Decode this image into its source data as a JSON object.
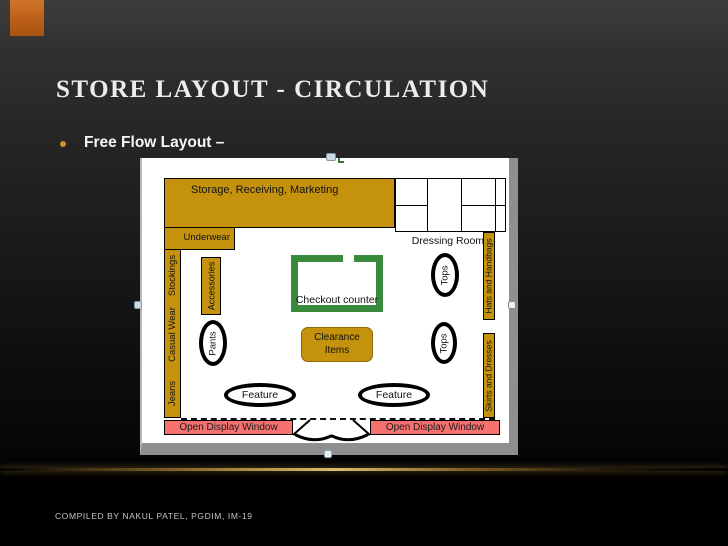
{
  "slide": {
    "title": "STORE LAYOUT - CIRCULATION",
    "bullet_text": "Free Flow Layout –",
    "footer": "COMPILED BY NAKUL PATEL, PGDIM, IM-19"
  },
  "diagram": {
    "storage": "Storage,  Receiving,  Marketing",
    "underwear": "Underwear",
    "wall_left": {
      "stockings": "Stockings",
      "casual_wear": "Casual Wear",
      "jeans": "Jeans"
    },
    "accessories": "Accessories",
    "pants": "Pants",
    "dressing_rooms": "Dressing Rooms",
    "hats": "Hats and Handbags",
    "skirts": "Skirts and Dresses",
    "tops_upper": "Tops",
    "tops_lower": "Tops",
    "checkout": "Checkout counter",
    "clearance": "Clearance Items",
    "feature_left": "Feature",
    "feature_right": "Feature",
    "open_display_left": "Open Display Window",
    "open_display_right": "Open Display Window"
  },
  "colors": {
    "fixture_gold": "#C5920D",
    "checkout_green": "#3A8A3E",
    "display_window_red": "#F5716F",
    "accent_orange": "#BB5F18",
    "glow_gold": "#DEBC6E",
    "selection_handle_blue": "#CDD9E0"
  }
}
